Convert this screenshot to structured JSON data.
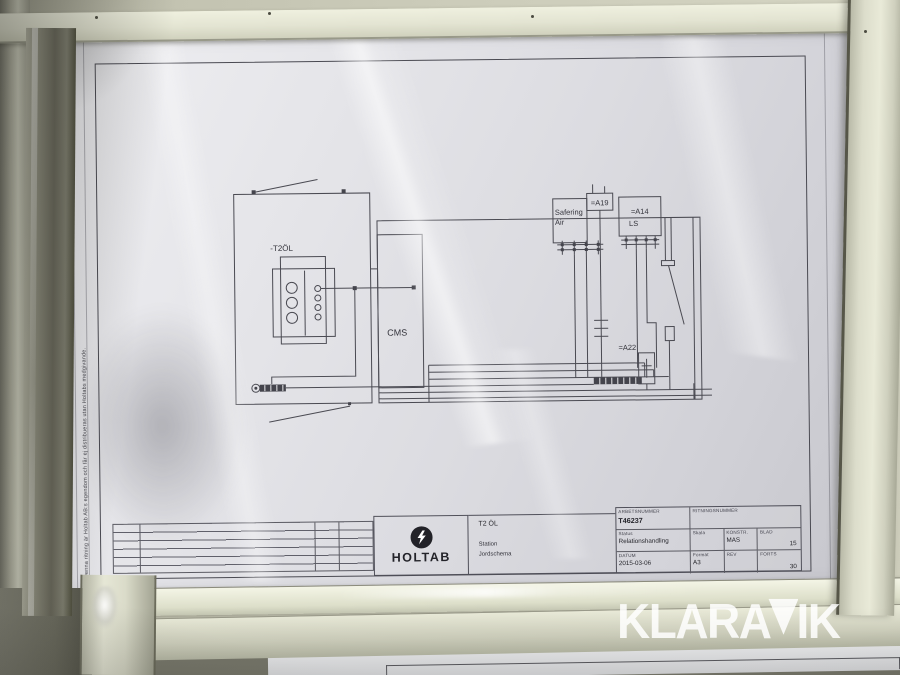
{
  "watermark": {
    "text": "KLARAVIK",
    "part_before_v": "KLARA",
    "part_after_v": "IK",
    "color": "#ffffff"
  },
  "drawing": {
    "ownership_note": "Denna ritning är Holtab AB:s egendom och får ej distribueras utan Holtabs medgivande.",
    "schematic": {
      "transformer_label": "-T2ÖL",
      "cms_label": "CMS",
      "safering_label_line1": "Safering",
      "safering_label_line2": "Air",
      "a19_label": "=A19",
      "a14_label": "=A14",
      "a14_sublabel": "LS",
      "a22_label": "=A22"
    },
    "title_block": {
      "company": "HOLTAB",
      "logo_icon": "lightning-bolt-in-circle",
      "title": "T2 ÖL",
      "subtitle_line1": "Station",
      "subtitle_line2": "Jordschema",
      "revision_table_empty_rows": 6,
      "fields": {
        "arbetsnummer_label": "ARBETSNUMMER",
        "arbetsnummer_value": "T46237",
        "ritningsnummer_label": "RITNINGSNUMMER",
        "ritningsnummer_value": "",
        "status_label": "Status",
        "status_value": "Relationshandling",
        "skala_label": "Skala",
        "skala_value": "",
        "konstr_label": "KONSTR.",
        "konstr_value": "MAS",
        "blad_label": "BLAD",
        "blad_value": "15",
        "datum_label": "DATUM",
        "datum_value": "2015-03-06",
        "format_label": "Format",
        "format_value": "A3",
        "rev_label": "REV",
        "rev_value": "",
        "forts_label": "FORTS",
        "forts_value": "30"
      }
    }
  },
  "colors": {
    "wall": "#cbcbb9",
    "frame": "#e4e5d3",
    "paper": "#e6e6ea",
    "drawing_line": "#45454b",
    "watermark": "rgba(255,255,255,0.85)"
  }
}
